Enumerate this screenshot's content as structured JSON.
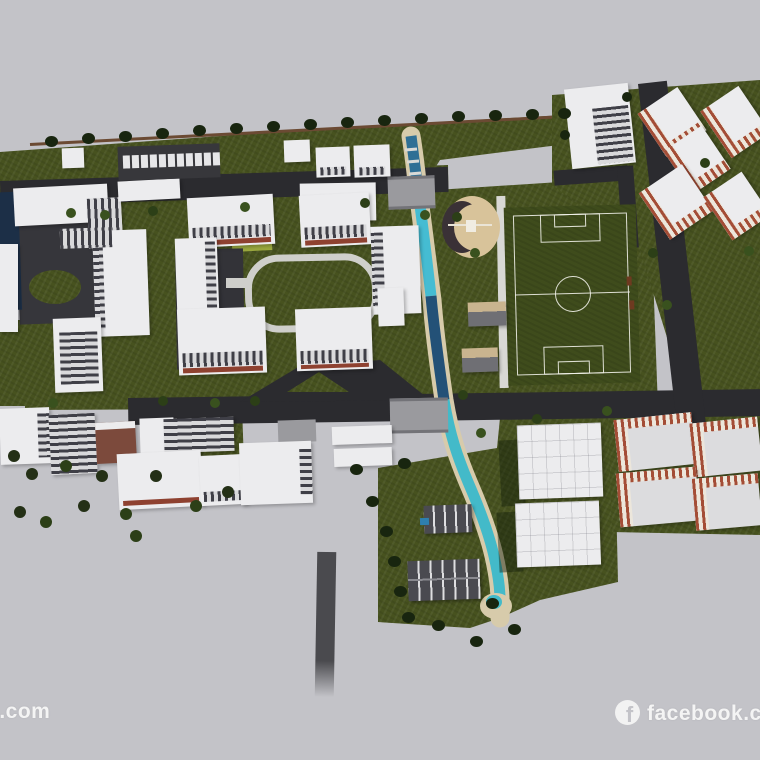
{
  "canvas": {
    "width": 760,
    "height": 760,
    "background": "#c3c3c8"
  },
  "scene": {
    "type": "3d-aerial-architectural-masterplan-render",
    "description": "Bird's-eye 3D rendering of a campus and residential master plan with white academic buildings, red-trimmed apartment blocks, a winding turquoise canal with two bridges, a soccer field, a semicircular amphitheater, parking with white cars, dark service sheds, roads and rows of palm trees on grey ground"
  },
  "footer": {
    "left_watermark": "n.com",
    "right_watermark": "facebook.com",
    "facebook_icon_letter": "f"
  },
  "colors": {
    "background_gray": "#c3c3c8",
    "grass_green": "#47521f",
    "field_green": "#3f4c1c",
    "road_dark": "#2b2b2f",
    "canal_turquoise": "#45bcd2",
    "canal_deep_blue": "#235177",
    "canal_bank_beige": "#d7cbab",
    "building_white": "#ececee",
    "brick_red": "#a44d36",
    "pool_navy": "#1c2f47",
    "amphitheater_tan": "#d8c39a",
    "watermark_white": "#f4f4f4",
    "palm_dark_green": "#18250f"
  }
}
